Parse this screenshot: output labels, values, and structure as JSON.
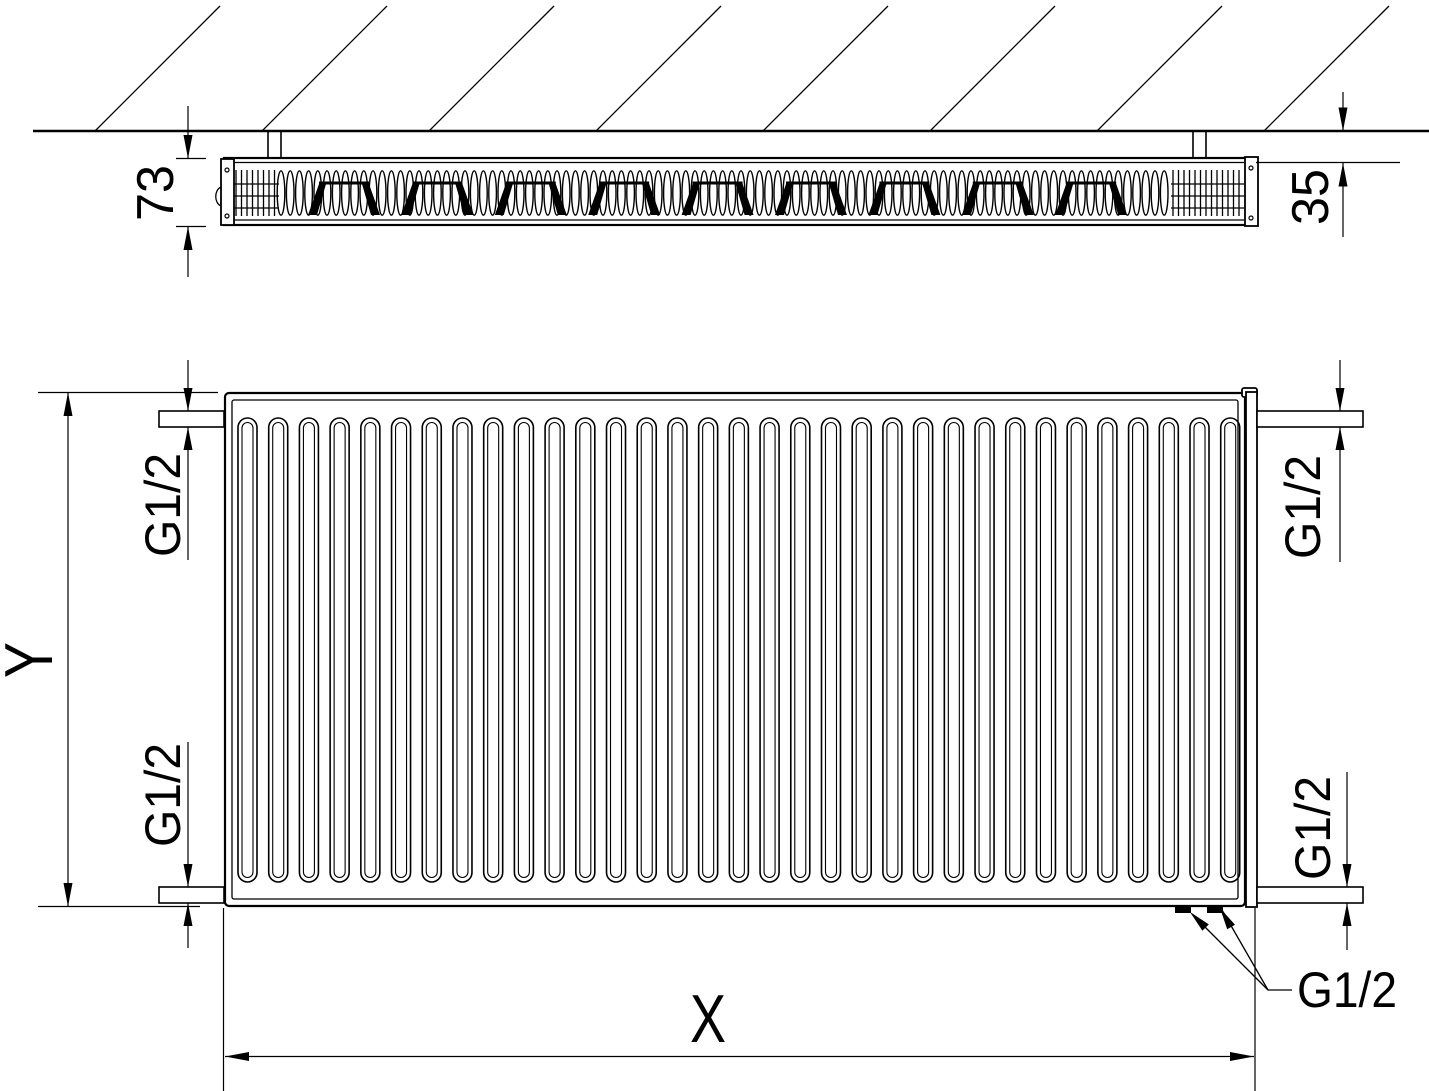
{
  "drawing": {
    "type": "radiator technical dimension drawing",
    "views": [
      "top-section-view",
      "front-view"
    ],
    "line_color": "#000000",
    "background_color": "#ffffff"
  },
  "labels": {
    "depth": "73",
    "wall_distance": "35",
    "height": "Y",
    "width": "X",
    "thread_top_left": "G1/2",
    "thread_bottom_left": "G1/2",
    "thread_top_right": "G1/2",
    "thread_bottom_right": "G1/2",
    "thread_bottom_ports": "G1/2"
  },
  "patterns": {
    "hatch": {
      "count": 8,
      "start_x": 95,
      "spacing": 167,
      "wall_y": 131,
      "run": 125,
      "top_y": 6
    },
    "top_fins": {
      "count": 97,
      "start_x": 281,
      "pitch": 9.2,
      "cy": 193,
      "rx": 3.8,
      "ry": 22.2
    },
    "staples": {
      "count": 9,
      "start_x": 344,
      "pitch": 93.4,
      "bar_y": 183,
      "bottom_y": 215,
      "half_bar": 25
    },
    "grids": [
      {
        "x0": 234,
        "x1": 279
      },
      {
        "x0": 1171,
        "x1": 1244
      }
    ],
    "grid_style": {
      "pitch": 5.5,
      "top": 170,
      "bottom": 216,
      "rails": [
        184,
        196,
        208
      ]
    },
    "front_slots": {
      "count": 33,
      "start_cx": 247.5,
      "pitch": 30.71,
      "top": 418,
      "height": 464,
      "outer_w": 19,
      "inner_w": 11
    }
  }
}
